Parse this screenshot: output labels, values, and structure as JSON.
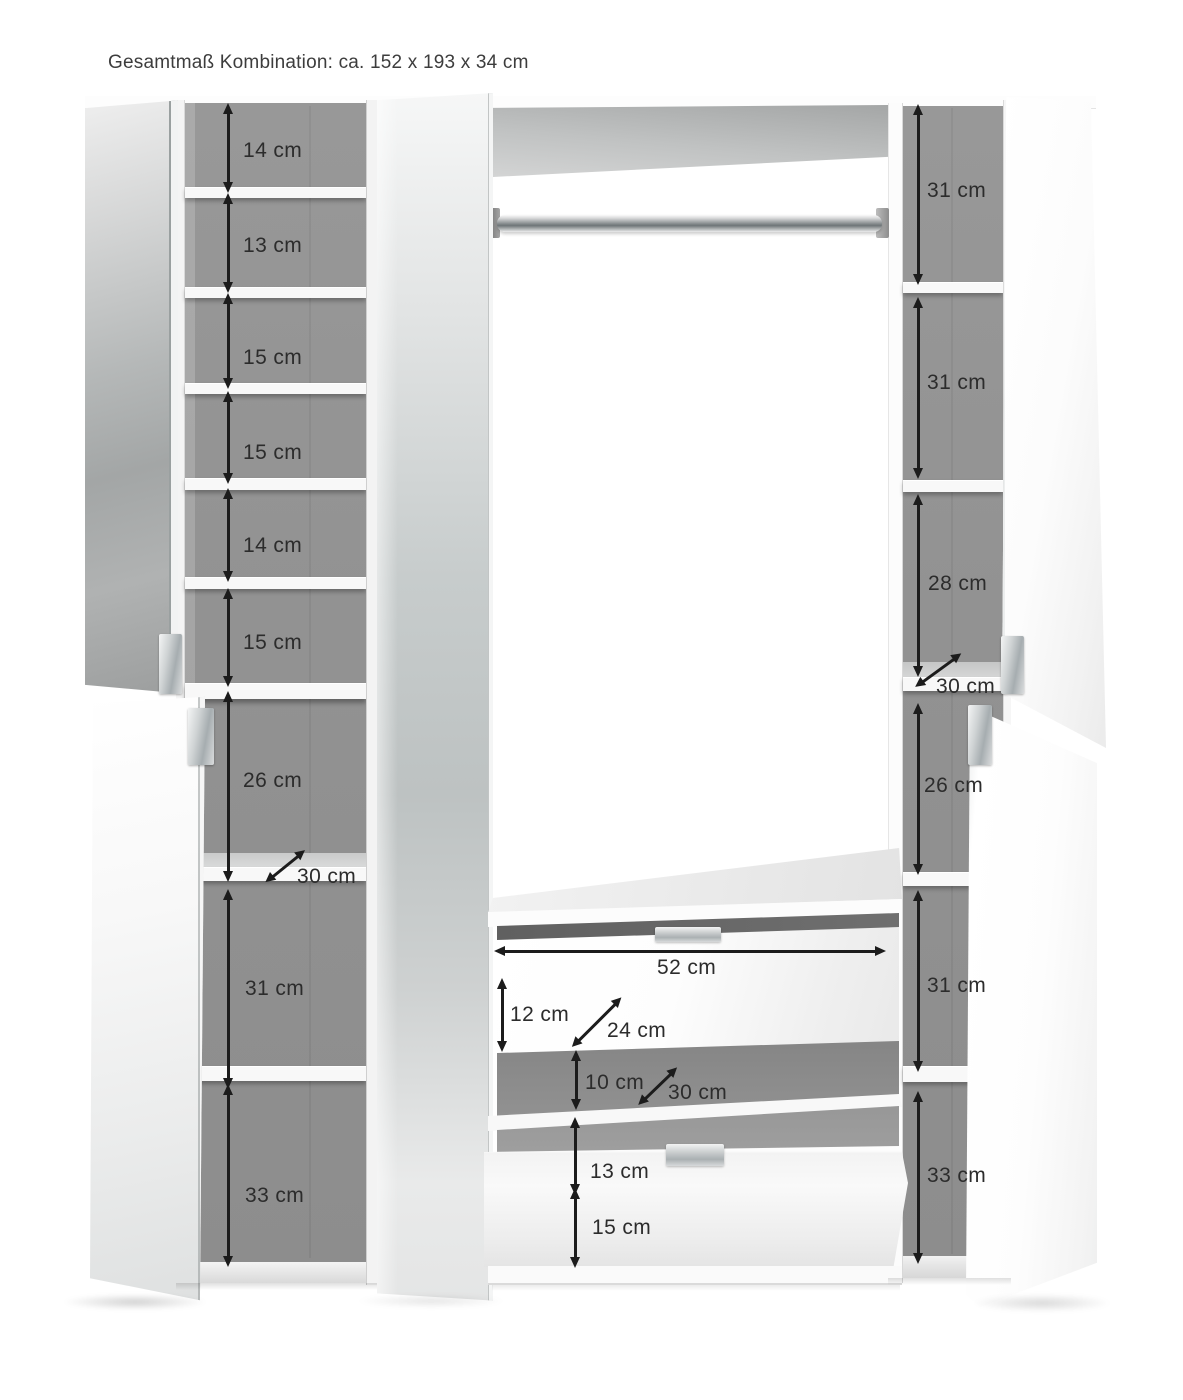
{
  "title": "Gesamtmaß Kombination: ca. 152 x 193 x 34 cm",
  "colors": {
    "arrow": "#1c1c1c",
    "interior_gray": "#929292",
    "background": "#ffffff"
  },
  "annotations": {
    "left": [
      {
        "label": "14 cm"
      },
      {
        "label": "13 cm"
      },
      {
        "label": "15 cm"
      },
      {
        "label": "15 cm"
      },
      {
        "label": "14 cm"
      },
      {
        "label": "15 cm"
      },
      {
        "label": "26 cm"
      },
      {
        "label": "30 cm"
      },
      {
        "label": "31 cm"
      },
      {
        "label": "33 cm"
      }
    ],
    "middle": [
      {
        "label": "52 cm"
      },
      {
        "label": "12 cm"
      },
      {
        "label": "24 cm"
      },
      {
        "label": "10 cm"
      },
      {
        "label": "30 cm"
      },
      {
        "label": "13 cm"
      },
      {
        "label": "15 cm"
      }
    ],
    "right": [
      {
        "label": "31 cm"
      },
      {
        "label": "31 cm"
      },
      {
        "label": "28 cm"
      },
      {
        "label": "30 cm"
      },
      {
        "label": "26 cm"
      },
      {
        "label": "31 cm"
      },
      {
        "label": "33 cm"
      }
    ]
  }
}
